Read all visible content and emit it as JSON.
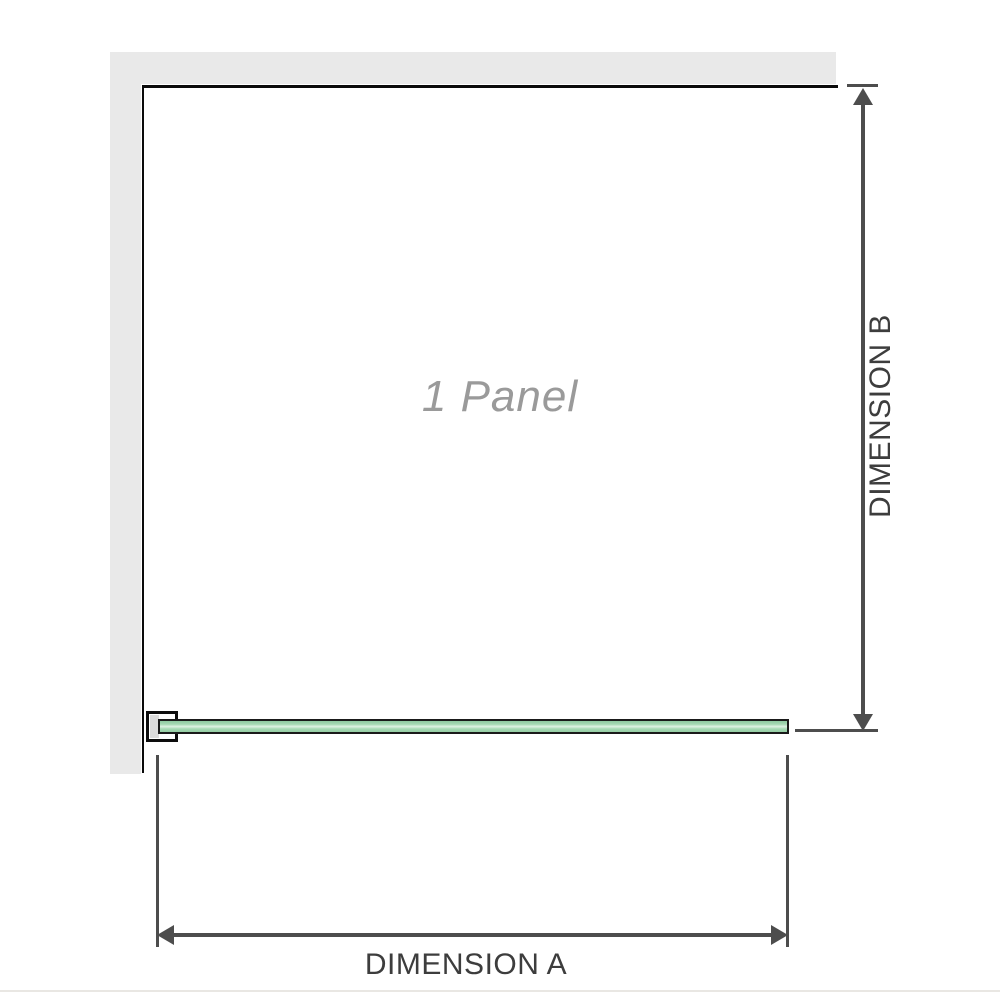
{
  "diagram": {
    "panel_label": "1 Panel",
    "dimension_a": {
      "label": "DIMENSION A"
    },
    "dimension_b": {
      "label": "DIMENSION B"
    },
    "colors": {
      "wall_gray": "#e9e9e9",
      "glass_green": "#a6d9b4",
      "glass_highlight": "#dff2e3",
      "glass_border": "#1a1a1a",
      "outline_black": "#0a0a0a",
      "dimension_line_gray": "#4d4d4d",
      "dimension_text_gray": "#3d3d3d",
      "panel_label_gray": "#9a9a9a",
      "bracket_insert_gray": "#dcdcdc"
    }
  }
}
